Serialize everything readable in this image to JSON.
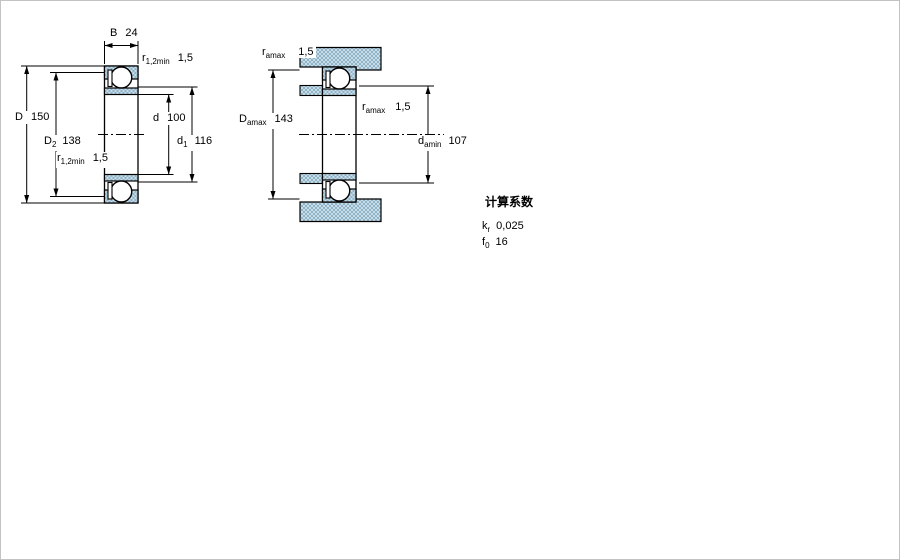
{
  "colors": {
    "line": "#000000",
    "hatch_base": "#c9dde8",
    "hatch_dot": "#8fb4c7",
    "background": "#ffffff"
  },
  "views": {
    "left": {
      "description": "bearing cross-section with boundary dimensions",
      "dims": {
        "B": {
          "main": "B",
          "sub": "",
          "value": "24"
        },
        "D": {
          "main": "D",
          "sub": "",
          "value": "150"
        },
        "D2": {
          "main": "D",
          "sub": "2",
          "value": "138"
        },
        "r_top": {
          "main": "r",
          "sub": "1,2min",
          "value": "1,5"
        },
        "r_bottom": {
          "main": "r",
          "sub": "1,2min",
          "value": "1,5"
        },
        "d": {
          "main": "d",
          "sub": "",
          "value": "100"
        },
        "d1": {
          "main": "d",
          "sub": "1",
          "value": "116"
        }
      }
    },
    "right": {
      "description": "mounted bearing with abutment dimensions",
      "dims": {
        "r_amax_top": {
          "main": "r",
          "sub": "amax",
          "value": "1,5"
        },
        "D_amax": {
          "main": "D",
          "sub": "amax",
          "value": "143"
        },
        "r_amax_mid": {
          "main": "r",
          "sub": "amax",
          "value": "1,5"
        },
        "d_amin": {
          "main": "d",
          "sub": "amin",
          "value": "107"
        }
      }
    }
  },
  "calculation_factors": {
    "title": "计算系数",
    "rows": [
      {
        "main": "k",
        "sub": "r",
        "value": "0,025"
      },
      {
        "main": "f",
        "sub": "0",
        "value": "16"
      }
    ]
  }
}
